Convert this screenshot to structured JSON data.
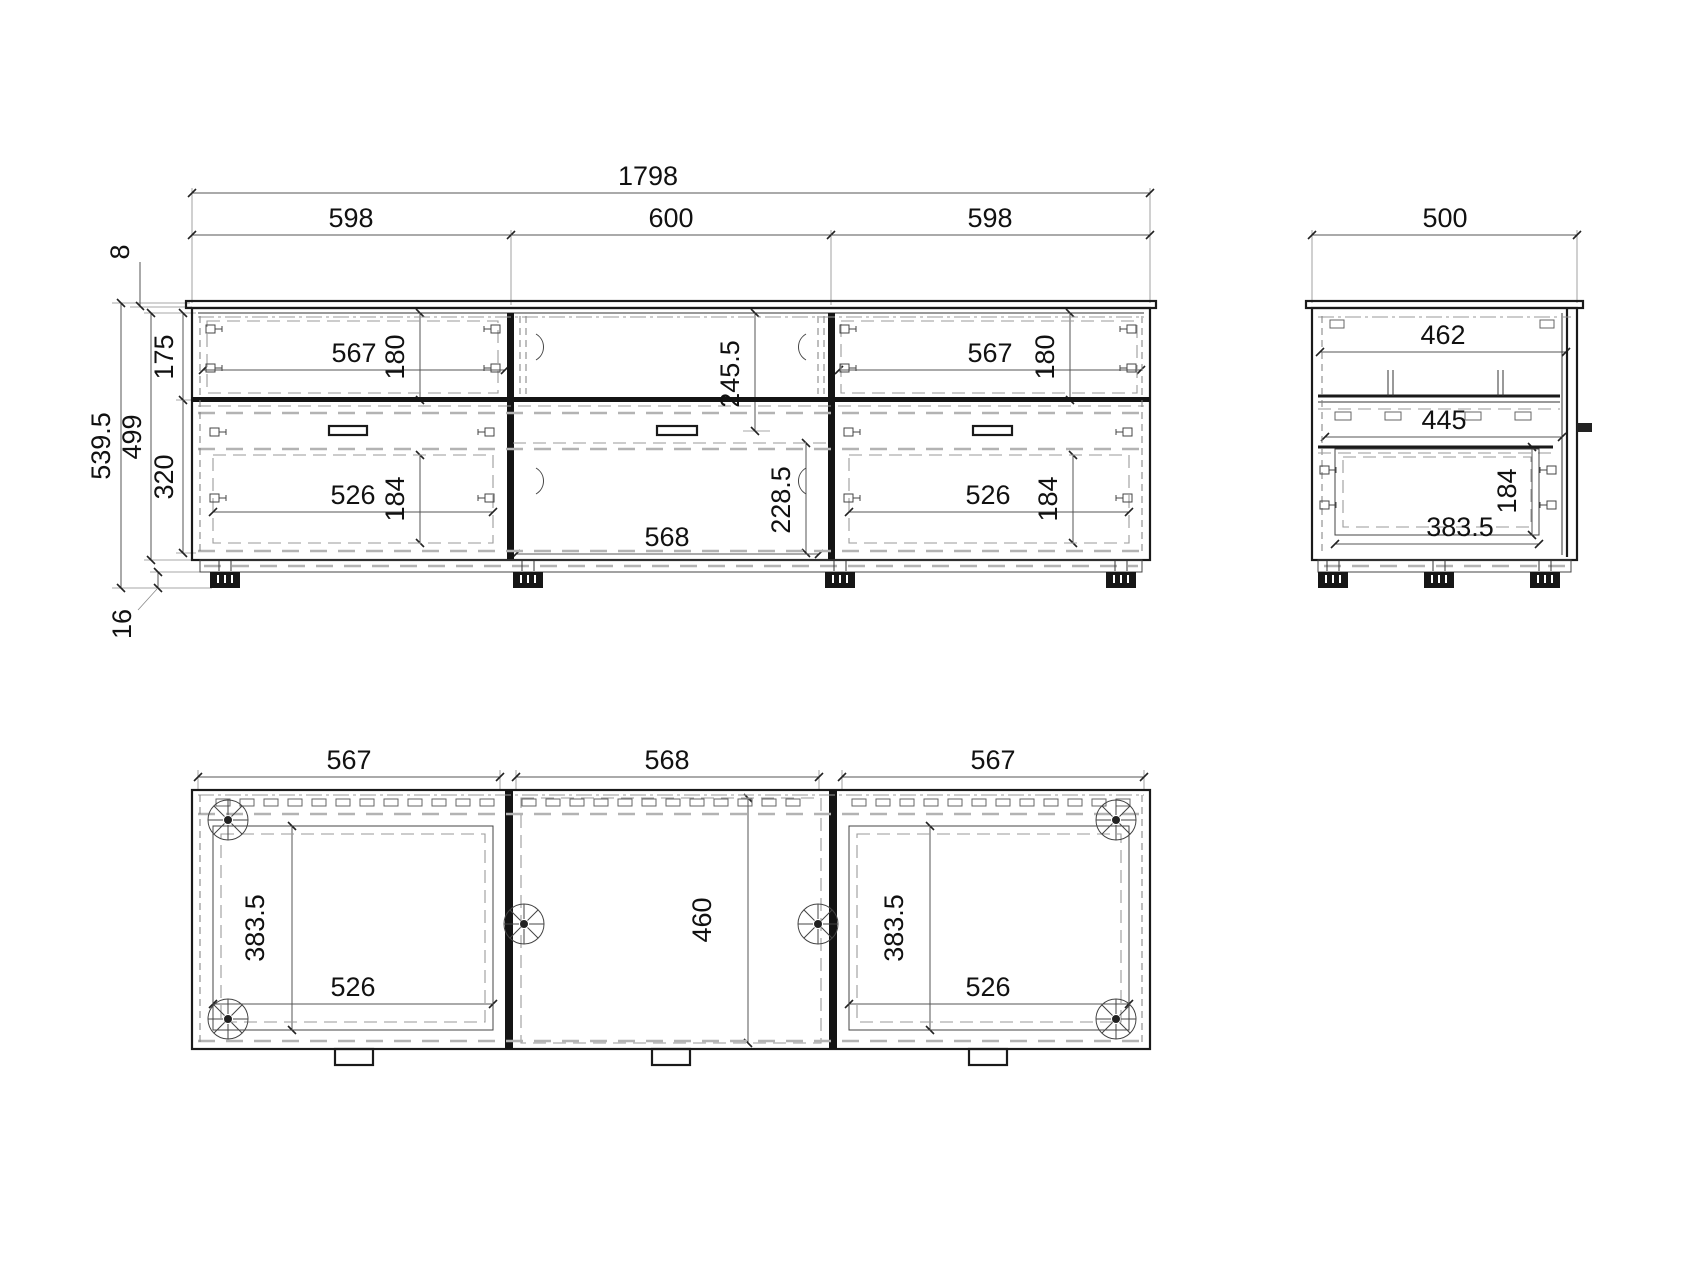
{
  "drawing": {
    "background_color": "#ffffff",
    "line_color": "#1a1a1a",
    "front": {
      "overall_width": "1798",
      "sections": [
        "598",
        "600",
        "598"
      ],
      "top_overhang": "8",
      "total_height": "539.5",
      "carcass_height": "499",
      "upper_height": "175",
      "lower_height": "320",
      "foot_height": "16",
      "drawer_front_width": "567",
      "drawer_front_height": "180",
      "drawer_box_width": "526",
      "drawer_box_height": "184",
      "center_opening_height": "245.5",
      "flap_width": "568",
      "flap_height": "228.5"
    },
    "side": {
      "depth": "500",
      "top_clear_depth": "462",
      "shelf_depth": "445",
      "opening_depth": "383.5",
      "opening_height": "184"
    },
    "plan": {
      "sections": [
        "567",
        "568",
        "567"
      ],
      "opening_depth": "383.5",
      "opening_width": "526",
      "center_depth": "460"
    }
  }
}
